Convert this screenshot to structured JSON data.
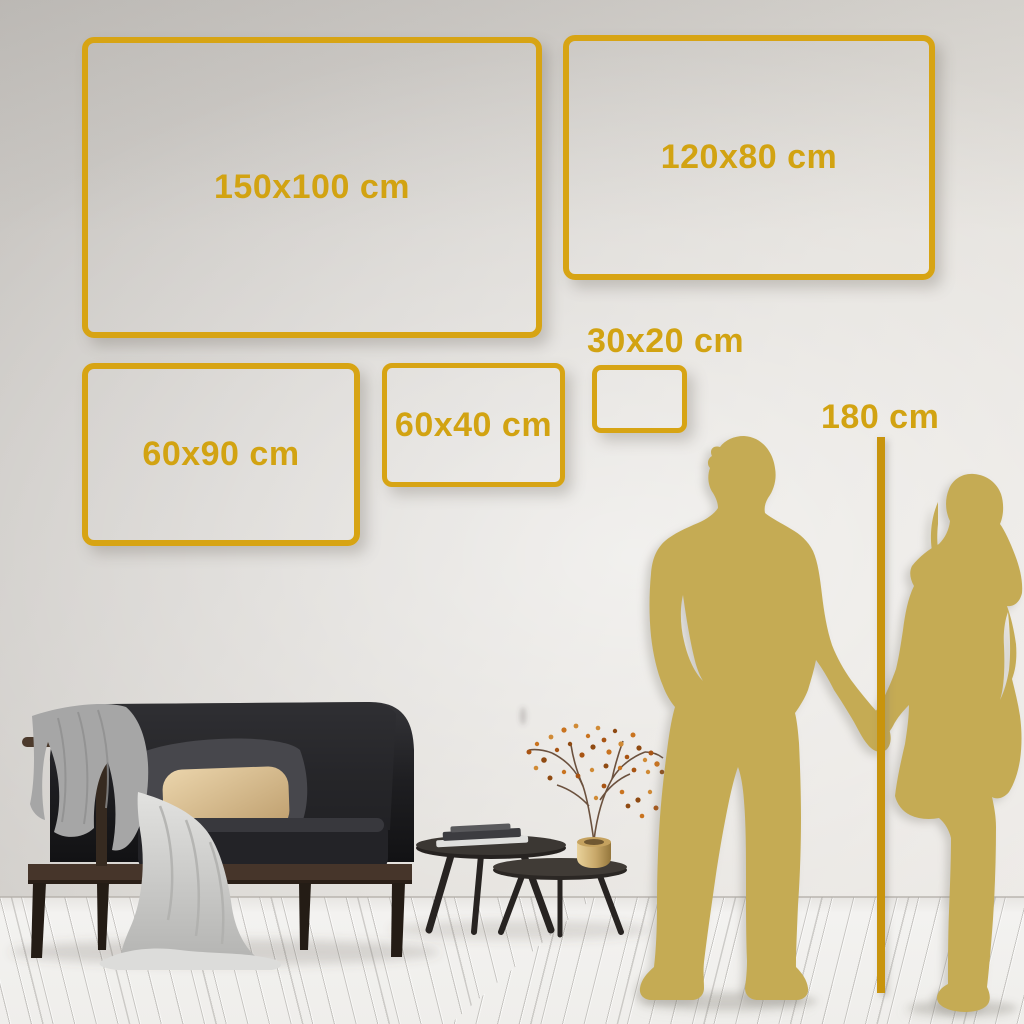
{
  "size_guide": {
    "frames": [
      {
        "id": "150x100",
        "label": "150x100 cm"
      },
      {
        "id": "120x80",
        "label": "120x80 cm"
      },
      {
        "id": "60x90",
        "label": "60x90 cm"
      },
      {
        "id": "60x40",
        "label": "60x40 cm"
      },
      {
        "id": "30x20",
        "label": "30x20 cm"
      }
    ],
    "height_marker": {
      "label": "180 cm"
    },
    "unit": "cm"
  },
  "colors": {
    "frame_gold": "#D7A414",
    "label_gold": "#D2A312",
    "ruler_gold": "#C8940E",
    "silhouette_gold": "#C5AB54",
    "wall_top": "#C7C4C0",
    "wall_bottom": "#EBE8E4",
    "floor": "#F1F0EE"
  },
  "scene": {
    "figures": [
      "man-silhouette",
      "woman-silhouette-holding-hands"
    ],
    "furniture": [
      "dark-velvet-sofa",
      "gray-blanket",
      "light-throw",
      "beige-pillow",
      "dark-pillow",
      "nested-coffee-tables",
      "book-stack",
      "brass-vase-with-dried-branch"
    ]
  }
}
